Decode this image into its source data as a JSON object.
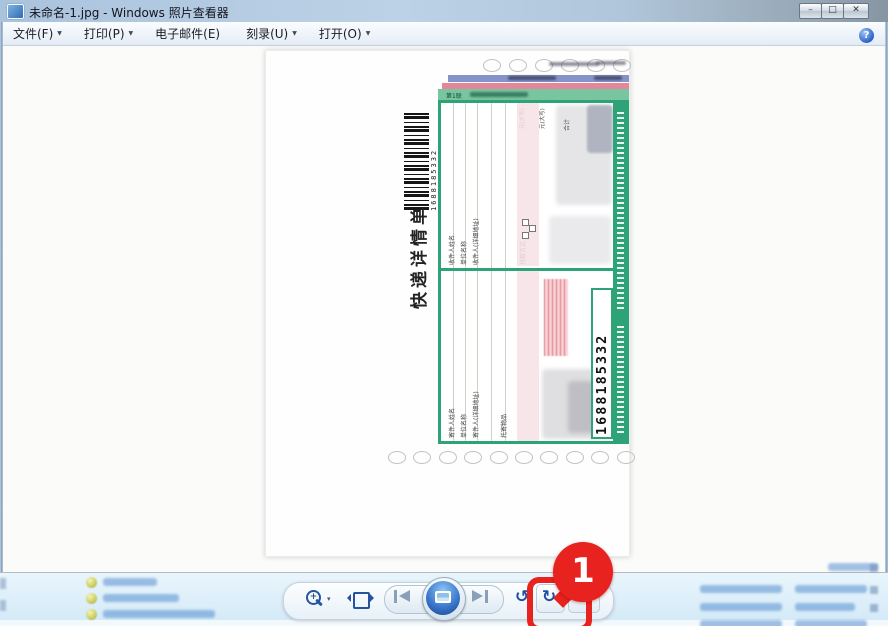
{
  "window_title": "未命名-1.jpg - Windows 照片查看器",
  "window_controls": {
    "minimize": "–",
    "maximize": "□",
    "close": "✕"
  },
  "menu": {
    "items": [
      {
        "label": "文件(F)",
        "dropdown": "▼"
      },
      {
        "label": "打印(P)",
        "dropdown": "▼"
      },
      {
        "label": "电子邮件(E)",
        "dropdown": ""
      },
      {
        "label": "刻录(U)",
        "dropdown": "▼"
      },
      {
        "label": "打开(O)",
        "dropdown": "▼"
      }
    ],
    "help": "?"
  },
  "photo_form": {
    "title_vertical": "快递详情单",
    "tracking_number": "1688185332",
    "barcode_number": "1688185332",
    "copy_strip_label": "第1联",
    "recipient_labels": [
      "收件人姓名",
      "单位名称",
      "收件人(详细地址)"
    ],
    "sender_labels": [
      "寄件人姓名",
      "单位名称",
      "寄件人(详细地址)"
    ],
    "misc_labels": {
      "payment": "付款方式",
      "amount_caps_1": "元(大写)",
      "amount_caps_2": "元(大写)",
      "total": "合计",
      "goods": "托寄物品"
    }
  },
  "toolbar": {
    "zoom_dropdown": "▾",
    "rotate_ccw": "↺",
    "rotate_cw": "↻",
    "delete": "✕"
  },
  "annotation": {
    "step": "1"
  },
  "colors": {
    "annotation_red": "#e8221e",
    "form_green": "#2da377",
    "strip_blue": "#8593c9",
    "strip_pink": "#e2889a"
  }
}
